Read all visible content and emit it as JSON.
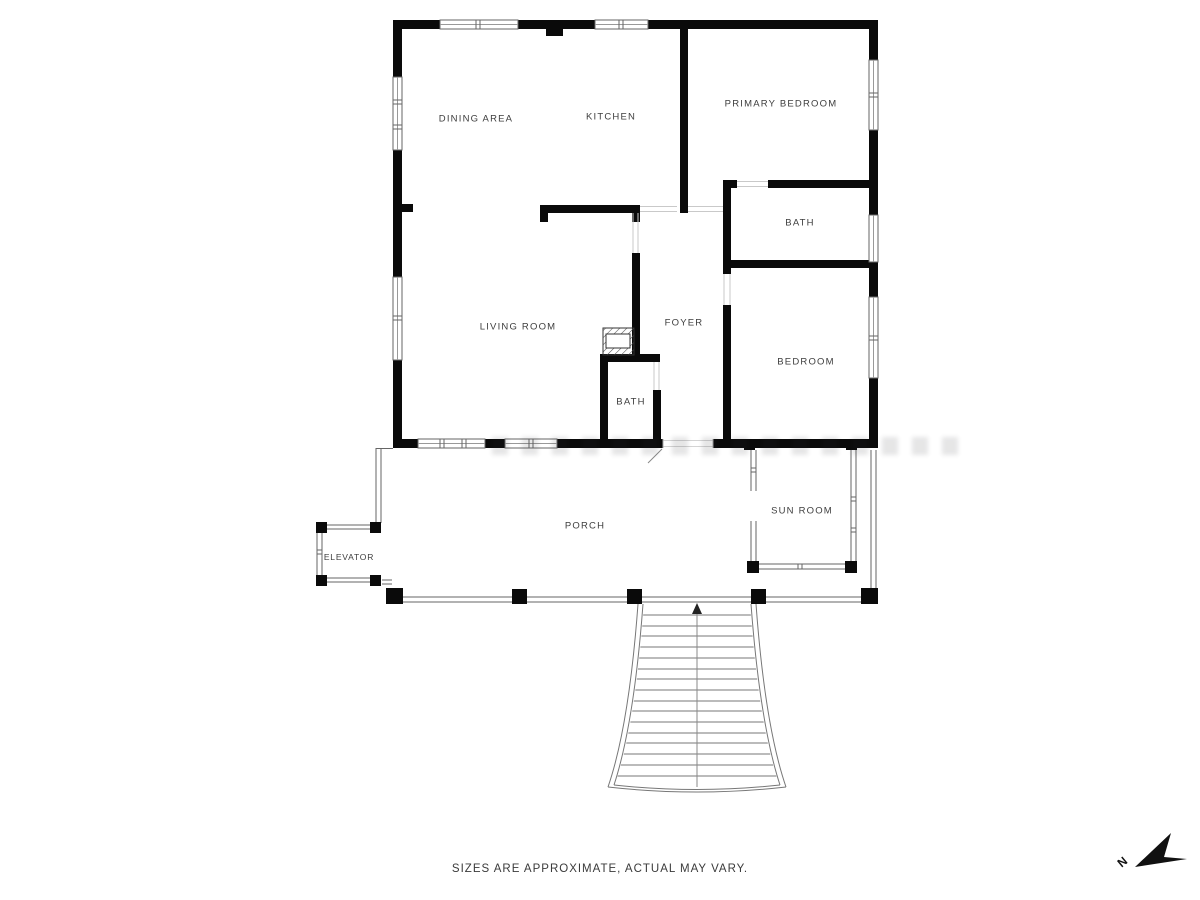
{
  "rooms": {
    "dining_area": "DINING AREA",
    "kitchen": "KITCHEN",
    "primary_bedroom": "PRIMARY BEDROOM",
    "bath_upper": "BATH",
    "living_room": "LIVING ROOM",
    "foyer": "FOYER",
    "bedroom": "BEDROOM",
    "bath_lower": "BATH",
    "sun_room": "SUN ROOM",
    "porch": "PORCH",
    "elevator": "ELEVATOR"
  },
  "footer": {
    "disclaimer": "SIZES ARE APPROXIMATE, ACTUAL MAY VARY."
  },
  "compass": {
    "north_label": "N"
  },
  "colors": {
    "wall": "#0a0a0a",
    "thin_line": "#666666",
    "label_text": "#3d3d3d",
    "background": "#ffffff"
  }
}
